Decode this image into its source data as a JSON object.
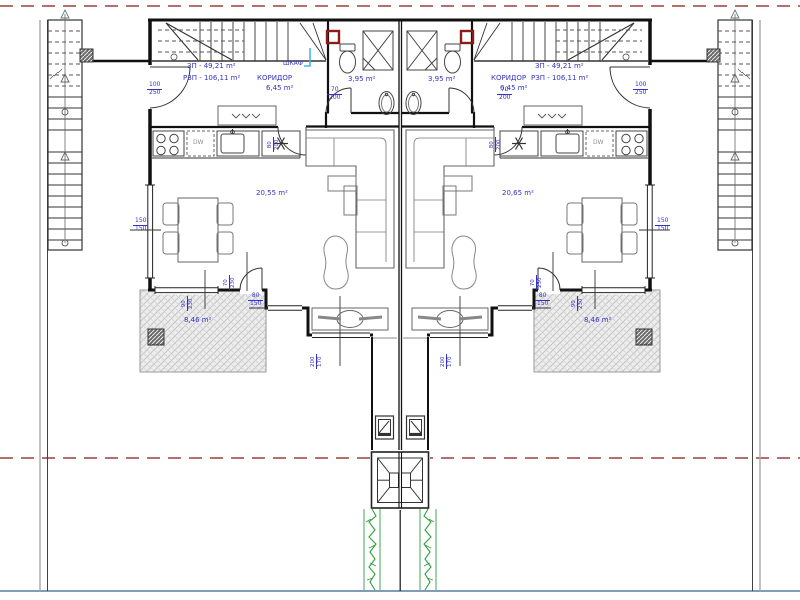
{
  "site": {
    "property_line_color": "#9c3f3f",
    "site_line_color": "#7f9db9",
    "hedge_color": "#2e9e3e"
  },
  "units": {
    "left": {
      "zp_label": "ЗП - 49,21 m²",
      "rzp_label": "РЗП - 106,11 m²",
      "corridor_name": "КОРИДОР",
      "corridor_area": "6,45 m²",
      "bathroom_area": "3,95 m²",
      "living_area": "20,55 m²",
      "terrace_area": "8,46 m²",
      "closet_label": "ШКАФ",
      "dishwasher_label": "DW"
    },
    "right": {
      "zp_label": "ЗП - 49,21 m²",
      "rzp_label": "РЗП - 106,11 m²",
      "corridor_name": "КОРИДОР",
      "corridor_area": "6,45 m²",
      "bathroom_area": "3,95 m²",
      "living_area": "20,65 m²",
      "terrace_area": "8,46 m²",
      "dishwasher_label": "DW"
    }
  },
  "dimensions": {
    "entry_door": {
      "w": "100",
      "h": "250"
    },
    "bathroom_door": {
      "w": "70",
      "h": "200"
    },
    "kitchen_door": {
      "w": "80",
      "h": "200"
    },
    "side_window": {
      "w": "80",
      "h": "150"
    },
    "facade_window": {
      "w": "150",
      "h": "150"
    },
    "terrace_door": {
      "w": "70",
      "h": "230"
    },
    "terrace_window": {
      "w": "90",
      "h": "230"
    },
    "living_window": {
      "w": "200",
      "h": "170"
    }
  }
}
